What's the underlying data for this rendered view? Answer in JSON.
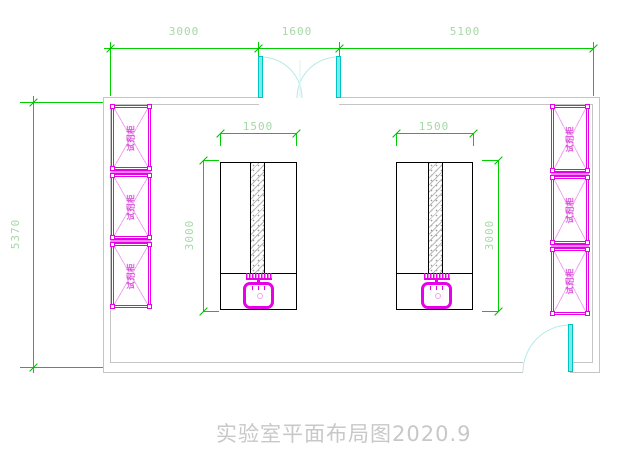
{
  "drawing": {
    "title": "实验室平面布局图2020.9"
  },
  "dims": {
    "top": [
      {
        "label": "3000"
      },
      {
        "label": "1600"
      },
      {
        "label": "5100"
      }
    ],
    "left": {
      "label": "5370"
    },
    "bench_left": {
      "width": "1500",
      "depth": "3000"
    },
    "bench_right": {
      "width": "1500",
      "depth": "3000"
    }
  },
  "cabinets": {
    "left": [
      {
        "label": "试剂柜"
      },
      {
        "label": "试剂柜"
      },
      {
        "label": "试剂柜"
      }
    ],
    "right": [
      {
        "label": "试剂柜"
      },
      {
        "label": "试剂柜"
      },
      {
        "label": "试剂柜"
      }
    ]
  },
  "colors": {
    "dimension_line_green": "#00d000",
    "dimension_text_green": "#a5d8a5",
    "fixture_magenta": "#ee00ee",
    "door_cyan": "#00d8d8",
    "wall_gray": "#c5c5c5",
    "title_gray": "#c8c8c8"
  }
}
